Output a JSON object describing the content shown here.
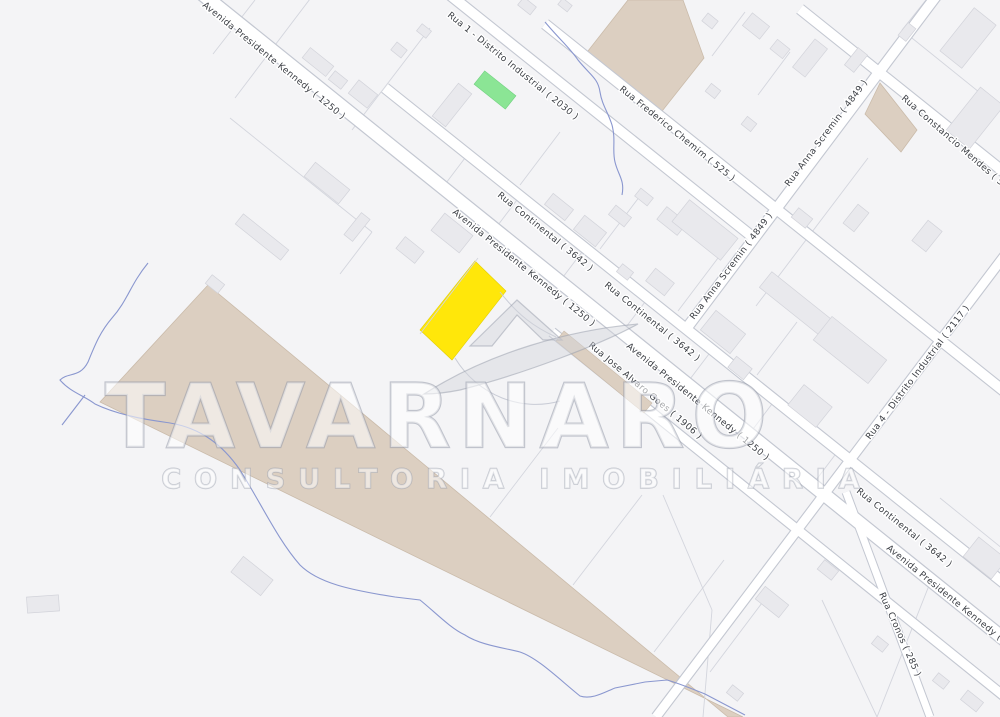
{
  "map_type": "cadastral real-estate map",
  "streets": {
    "kennedy": "Avenida Presidente Kennedy ( 1250 )",
    "rua1_distrito": "Rua 1 - Distrito Industrial ( 2030 )",
    "frederico": "Rua Frederico Chemim ( 525 )",
    "continental": "Rua Continental ( 3642 )",
    "anna": "Rua Anna Scremin ( 4849 )",
    "constancio": "Rua Constancio Mendes ( 5541 )",
    "rua4_distrito": "Rua 4 - Distrito Industrial ( 2117 )",
    "jose": "Rua Jose Alvaro Goes ( 1906 )",
    "cronos": "Rua Cronos ( 285 )"
  },
  "watermark": {
    "brand": "TAVARNARO",
    "tagline": "CONSULTORIA IMOBILIÁRIA"
  },
  "colors": {
    "background": "#f4f4f6",
    "highlight_parcel": "#ffe70a",
    "highlight_parcel_border": "#e3cf00",
    "green_area": "#8be595",
    "green_area_border": "#6fd07f",
    "land_beige": "#dccfc1",
    "land_beige_border": "#c9b9a8",
    "water": "#8a97cf",
    "building": "#e9e9ed",
    "street_casing": "#c3c7d1"
  }
}
